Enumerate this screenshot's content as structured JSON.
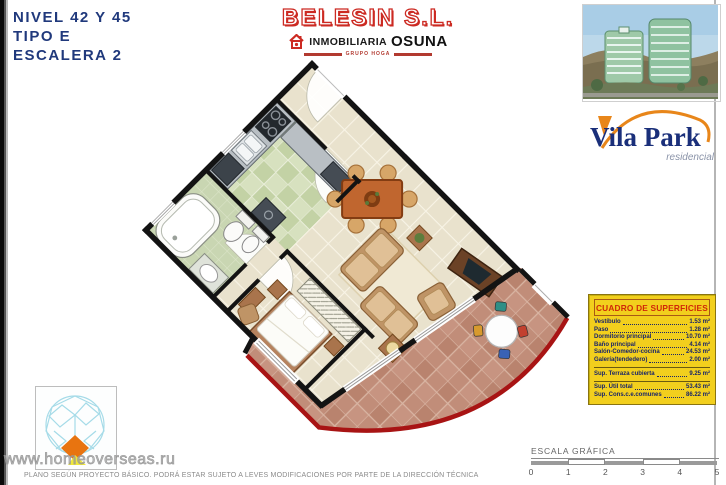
{
  "header": {
    "line1": "NIVEL 42 Y 45",
    "line2": "TIPO E",
    "line3": "ESCALERA 2"
  },
  "brand": {
    "belesin": "BELESIN S.L.",
    "inmobiliaria": "INMOBILIARIA",
    "osuna": "OSUNA",
    "grupo": "GRUPO HOGA"
  },
  "vilapark": {
    "name": "Vila Park",
    "subtitle": "residencial"
  },
  "surfaces": {
    "title": "CUADRO DE SUPERFICIES",
    "rows": [
      {
        "label": "Vestíbulo",
        "value": "1.53 m²"
      },
      {
        "label": "Paso",
        "value": "1.28 m²"
      },
      {
        "label": "Dormitorio principal",
        "value": "10.70 m²"
      },
      {
        "label": "Baño principal",
        "value": "4.14 m²"
      },
      {
        "label": "Salón-Comedor-cocina",
        "value": "24.53 m²"
      },
      {
        "label": "Galería(tendedero)",
        "value": "2.00 m²"
      },
      {
        "label": "Sup. Terraza cubierta",
        "value": "9.25 m²"
      },
      {
        "label": "Sup. Útil total",
        "value": "53.43 m²"
      },
      {
        "label": "Sup. Cons.c.e.comunes",
        "value": "86.22 m²"
      }
    ]
  },
  "scale": {
    "title": "ESCALA GRÁFICA",
    "ticks": [
      "0",
      "1",
      "2",
      "3",
      "4",
      "5"
    ]
  },
  "watermark": "www.homeoverseas.ru",
  "disclaimer": "PLANO SEGÚN PROYECTO BÁSICO. PODRÁ ESTAR SUJETO A LEVES MODIFICACIONES POR PARTE DE LA DIRECCIÓN TÉCNICA",
  "colors": {
    "navy_heading": "#20397c",
    "brand_red": "#cc2a22",
    "panel_yellow": "#f2cf1d",
    "panel_text": "#18246a",
    "terrace_red_facade": "#a81414",
    "terracotta_tile": "#c18d79",
    "kitchen_tile": "#c9d6b2",
    "floor_tile": "#e9e2cd",
    "wall_black": "#131313",
    "vilapark_orange": "#e8861a",
    "vilapark_navy": "#1a2f7a"
  }
}
